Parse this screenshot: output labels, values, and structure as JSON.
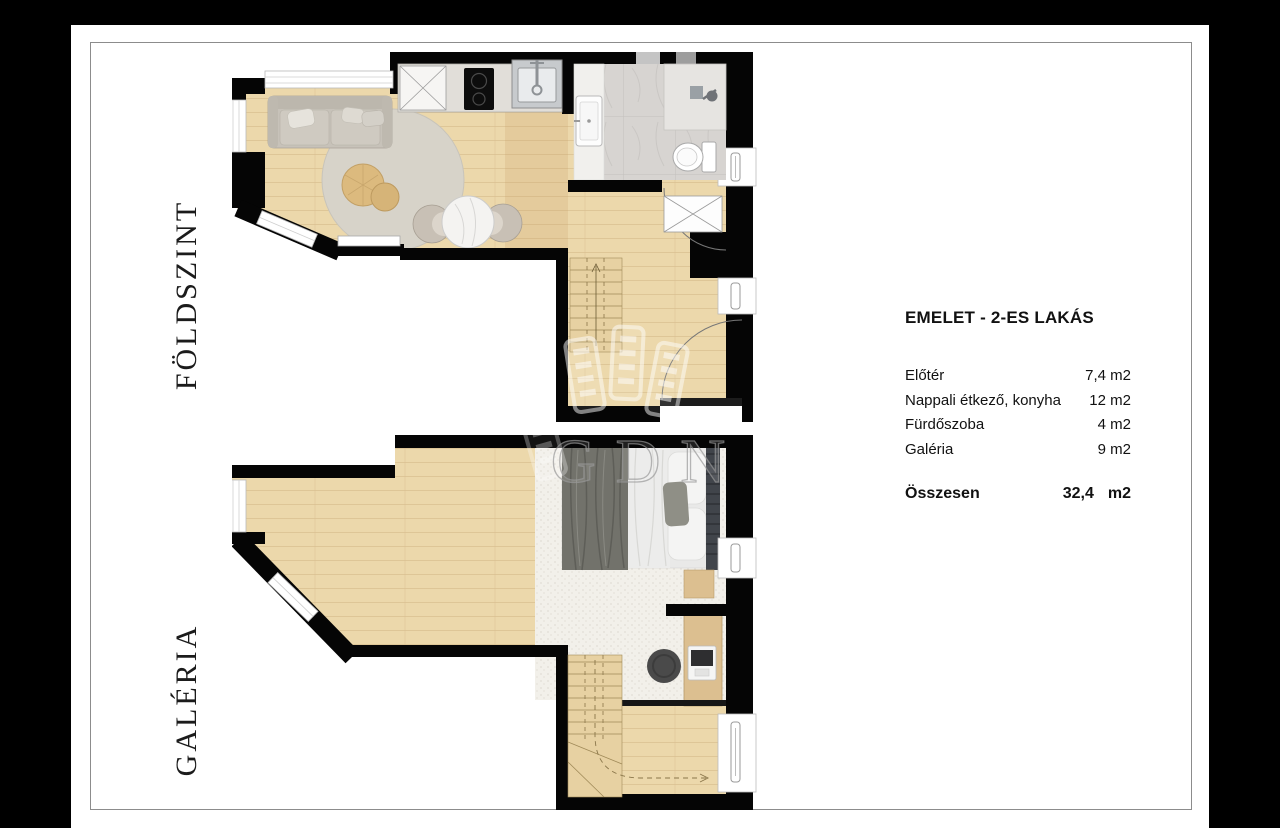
{
  "floor_labels": {
    "ground": "FÖLDSZINT",
    "gallery": "GALÉRIA"
  },
  "legend": {
    "title": "EMELET - 2-ES LAKÁS",
    "rooms": [
      {
        "name": "Előtér",
        "area": "7,4 m2"
      },
      {
        "name": "Nappali étkező, konyha",
        "area": "12 m2"
      },
      {
        "name": "Fürdőszoba",
        "area": "4 m2"
      },
      {
        "name": "Galéria",
        "area": "9 m2"
      }
    ],
    "total_label": "Összesen",
    "total_value": "32,4",
    "total_unit": "m2"
  },
  "watermark": {
    "text": "GDN"
  },
  "colors": {
    "background": "#000000",
    "paper": "#ffffff",
    "frame": "#8c8c8c",
    "wall": "#050505",
    "wood_floor": "#ecd8ab",
    "bathroom_tile": "#d7d4d1",
    "carpet": "#f2f0ea",
    "label_text": "#1b1b1b"
  }
}
